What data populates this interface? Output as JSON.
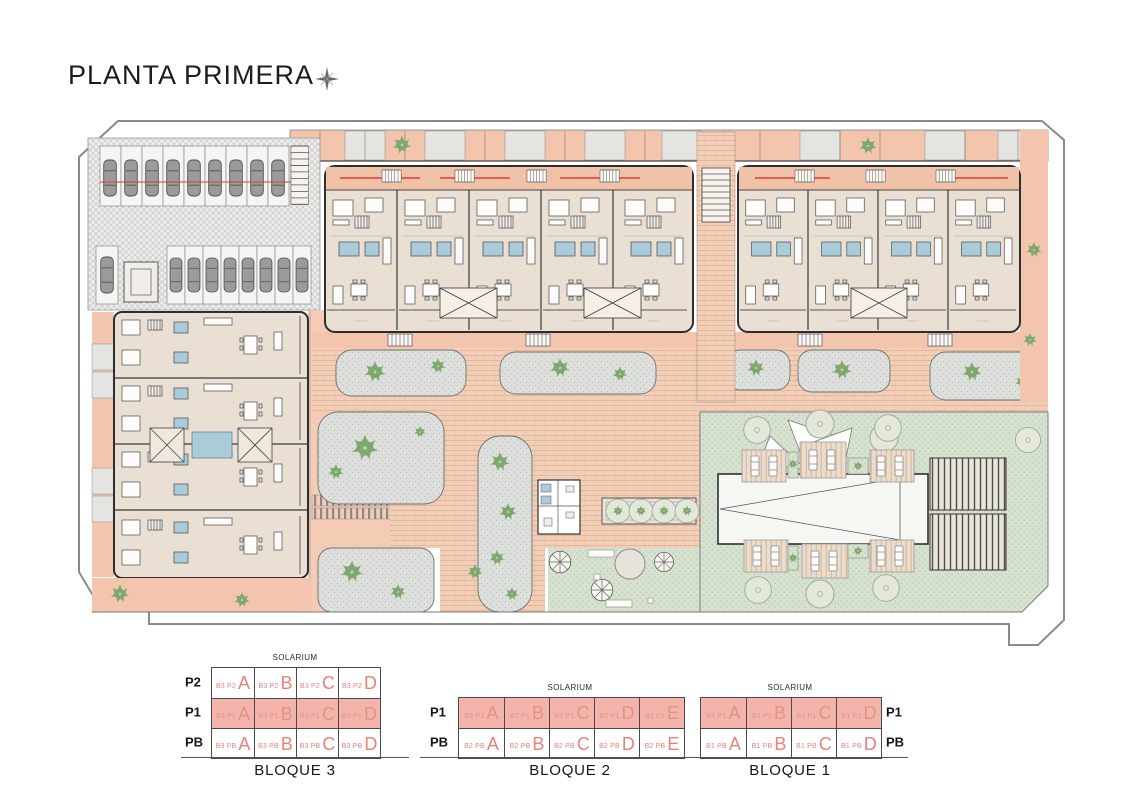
{
  "title": "PLANTA PRIMERA",
  "compass": "north-star",
  "legend": {
    "solarium_label": "SOLARIUM",
    "blocks": [
      {
        "name": "BLOQUE 3",
        "label_side": "left",
        "rows": [
          {
            "label": "P2",
            "highlighted": false,
            "cells": [
              {
                "code": "B3 P2",
                "letter": "A"
              },
              {
                "code": "B3 P2",
                "letter": "B"
              },
              {
                "code": "B3 P2",
                "letter": "C"
              },
              {
                "code": "B3 P2",
                "letter": "D"
              }
            ]
          },
          {
            "label": "P1",
            "highlighted": true,
            "cells": [
              {
                "code": "B3 P1",
                "letter": "A"
              },
              {
                "code": "B3 P1",
                "letter": "B"
              },
              {
                "code": "B3 P1",
                "letter": "C"
              },
              {
                "code": "B3 P1",
                "letter": "D"
              }
            ]
          },
          {
            "label": "PB",
            "highlighted": false,
            "cells": [
              {
                "code": "B3 PB",
                "letter": "A"
              },
              {
                "code": "B3 PB",
                "letter": "B"
              },
              {
                "code": "B3 PB",
                "letter": "C"
              },
              {
                "code": "B3 PB",
                "letter": "D"
              }
            ]
          }
        ]
      },
      {
        "name": "BLOQUE 2",
        "label_side": "left",
        "rows": [
          {
            "label": "P1",
            "highlighted": true,
            "cells": [
              {
                "code": "B2 P1",
                "letter": "A"
              },
              {
                "code": "B2 P1",
                "letter": "B"
              },
              {
                "code": "B2 P1",
                "letter": "C"
              },
              {
                "code": "B2 P1",
                "letter": "D"
              },
              {
                "code": "B2 P1",
                "letter": "E"
              }
            ]
          },
          {
            "label": "PB",
            "highlighted": false,
            "cells": [
              {
                "code": "B2 PB",
                "letter": "A"
              },
              {
                "code": "B2 PB",
                "letter": "B"
              },
              {
                "code": "B2 PB",
                "letter": "C"
              },
              {
                "code": "B2 PB",
                "letter": "D"
              },
              {
                "code": "B2 PB",
                "letter": "E"
              }
            ]
          }
        ]
      },
      {
        "name": "BLOQUE 1",
        "label_side": "right",
        "rows": [
          {
            "label": "P1",
            "highlighted": true,
            "cells": [
              {
                "code": "B1 P1",
                "letter": "A"
              },
              {
                "code": "B1 P1",
                "letter": "B"
              },
              {
                "code": "B1 P1",
                "letter": "C"
              },
              {
                "code": "B1 P1",
                "letter": "D"
              }
            ]
          },
          {
            "label": "PB",
            "highlighted": false,
            "cells": [
              {
                "code": "B1 PB",
                "letter": "A"
              },
              {
                "code": "B1 PB",
                "letter": "B"
              },
              {
                "code": "B1 PB",
                "letter": "C"
              },
              {
                "code": "B1 PB",
                "letter": "D"
              }
            ]
          }
        ]
      }
    ]
  },
  "colors": {
    "terrace_salmon": "#f2c5ac",
    "interior_beige": "#eadfd3",
    "brick_path": "#f3cfb7",
    "lawn_green": "#d6e2cf",
    "bed_gray": "#dcdfdc",
    "bathroom_blue": "#aacbd9",
    "tree_green": "#7ea86d",
    "accent_red": "#e23b30",
    "legend_red": "#e8827a",
    "legend_highlight": "#f5b4ab",
    "boundary_gray": "#8a8a8a"
  }
}
